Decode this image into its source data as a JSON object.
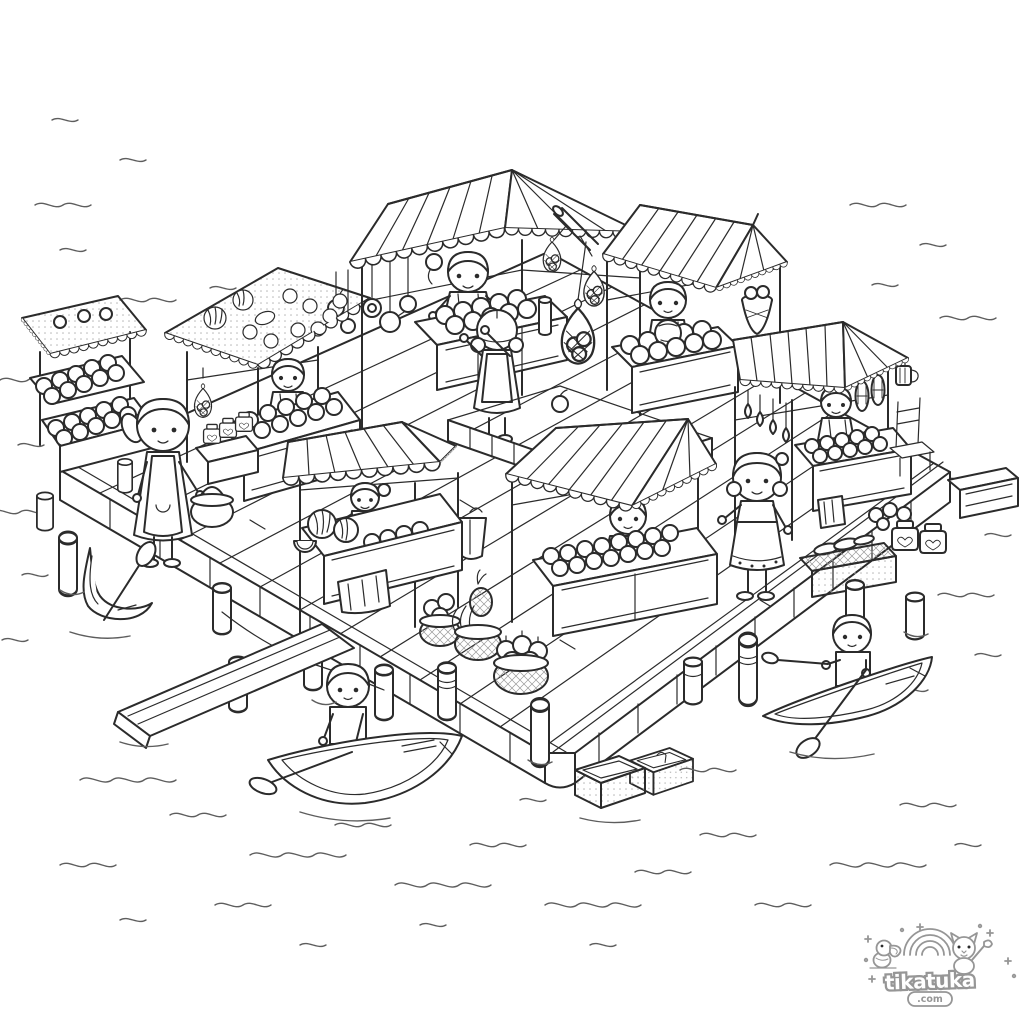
{
  "canvas": {
    "width": 1024,
    "height": 1024,
    "background": "#ffffff"
  },
  "style": {
    "ink": "#2b2b2b",
    "water_ink": "#5d5d5d",
    "logo_ink": "#969696",
    "texture": "#9a9a9a"
  },
  "logo": {
    "brand": "tikatuka",
    "suffix": ".com"
  },
  "scene": {
    "kind": "black-and-white line-art coloring page",
    "subject": "floating market on a wooden dock surrounded by water",
    "stalls": [
      {
        "id": "far-left-fruit-shelves"
      },
      {
        "id": "left-fruit-pattern-roof",
        "vendor": "boy"
      },
      {
        "id": "top-center-striped-awning",
        "vendor": "girl"
      },
      {
        "id": "top-right-striped-awning",
        "vendor": "boy"
      },
      {
        "id": "center-striped-awning",
        "vendor": "girl"
      },
      {
        "id": "center-right-striped-awning",
        "vendor": "boy"
      },
      {
        "id": "right-striped-awning",
        "vendor": "boy"
      }
    ],
    "people": [
      "girl shopper with basket",
      "girl customer in market pen",
      "woman shopper in apron",
      "boy rowing boat bottom-left",
      "boy rowing boat bottom-right"
    ],
    "objects": [
      "hanging net fruit bags",
      "hanging pans",
      "hanging gourds",
      "corn cobs",
      "mug",
      "pineapple-banana basket",
      "apple basket",
      "gourd basket",
      "vegetable crate",
      "jars",
      "floating crates",
      "gangplank",
      "mooring posts",
      "empty boat with paddle",
      "chair",
      "towel",
      "market pen with fruit",
      "water waves"
    ]
  }
}
